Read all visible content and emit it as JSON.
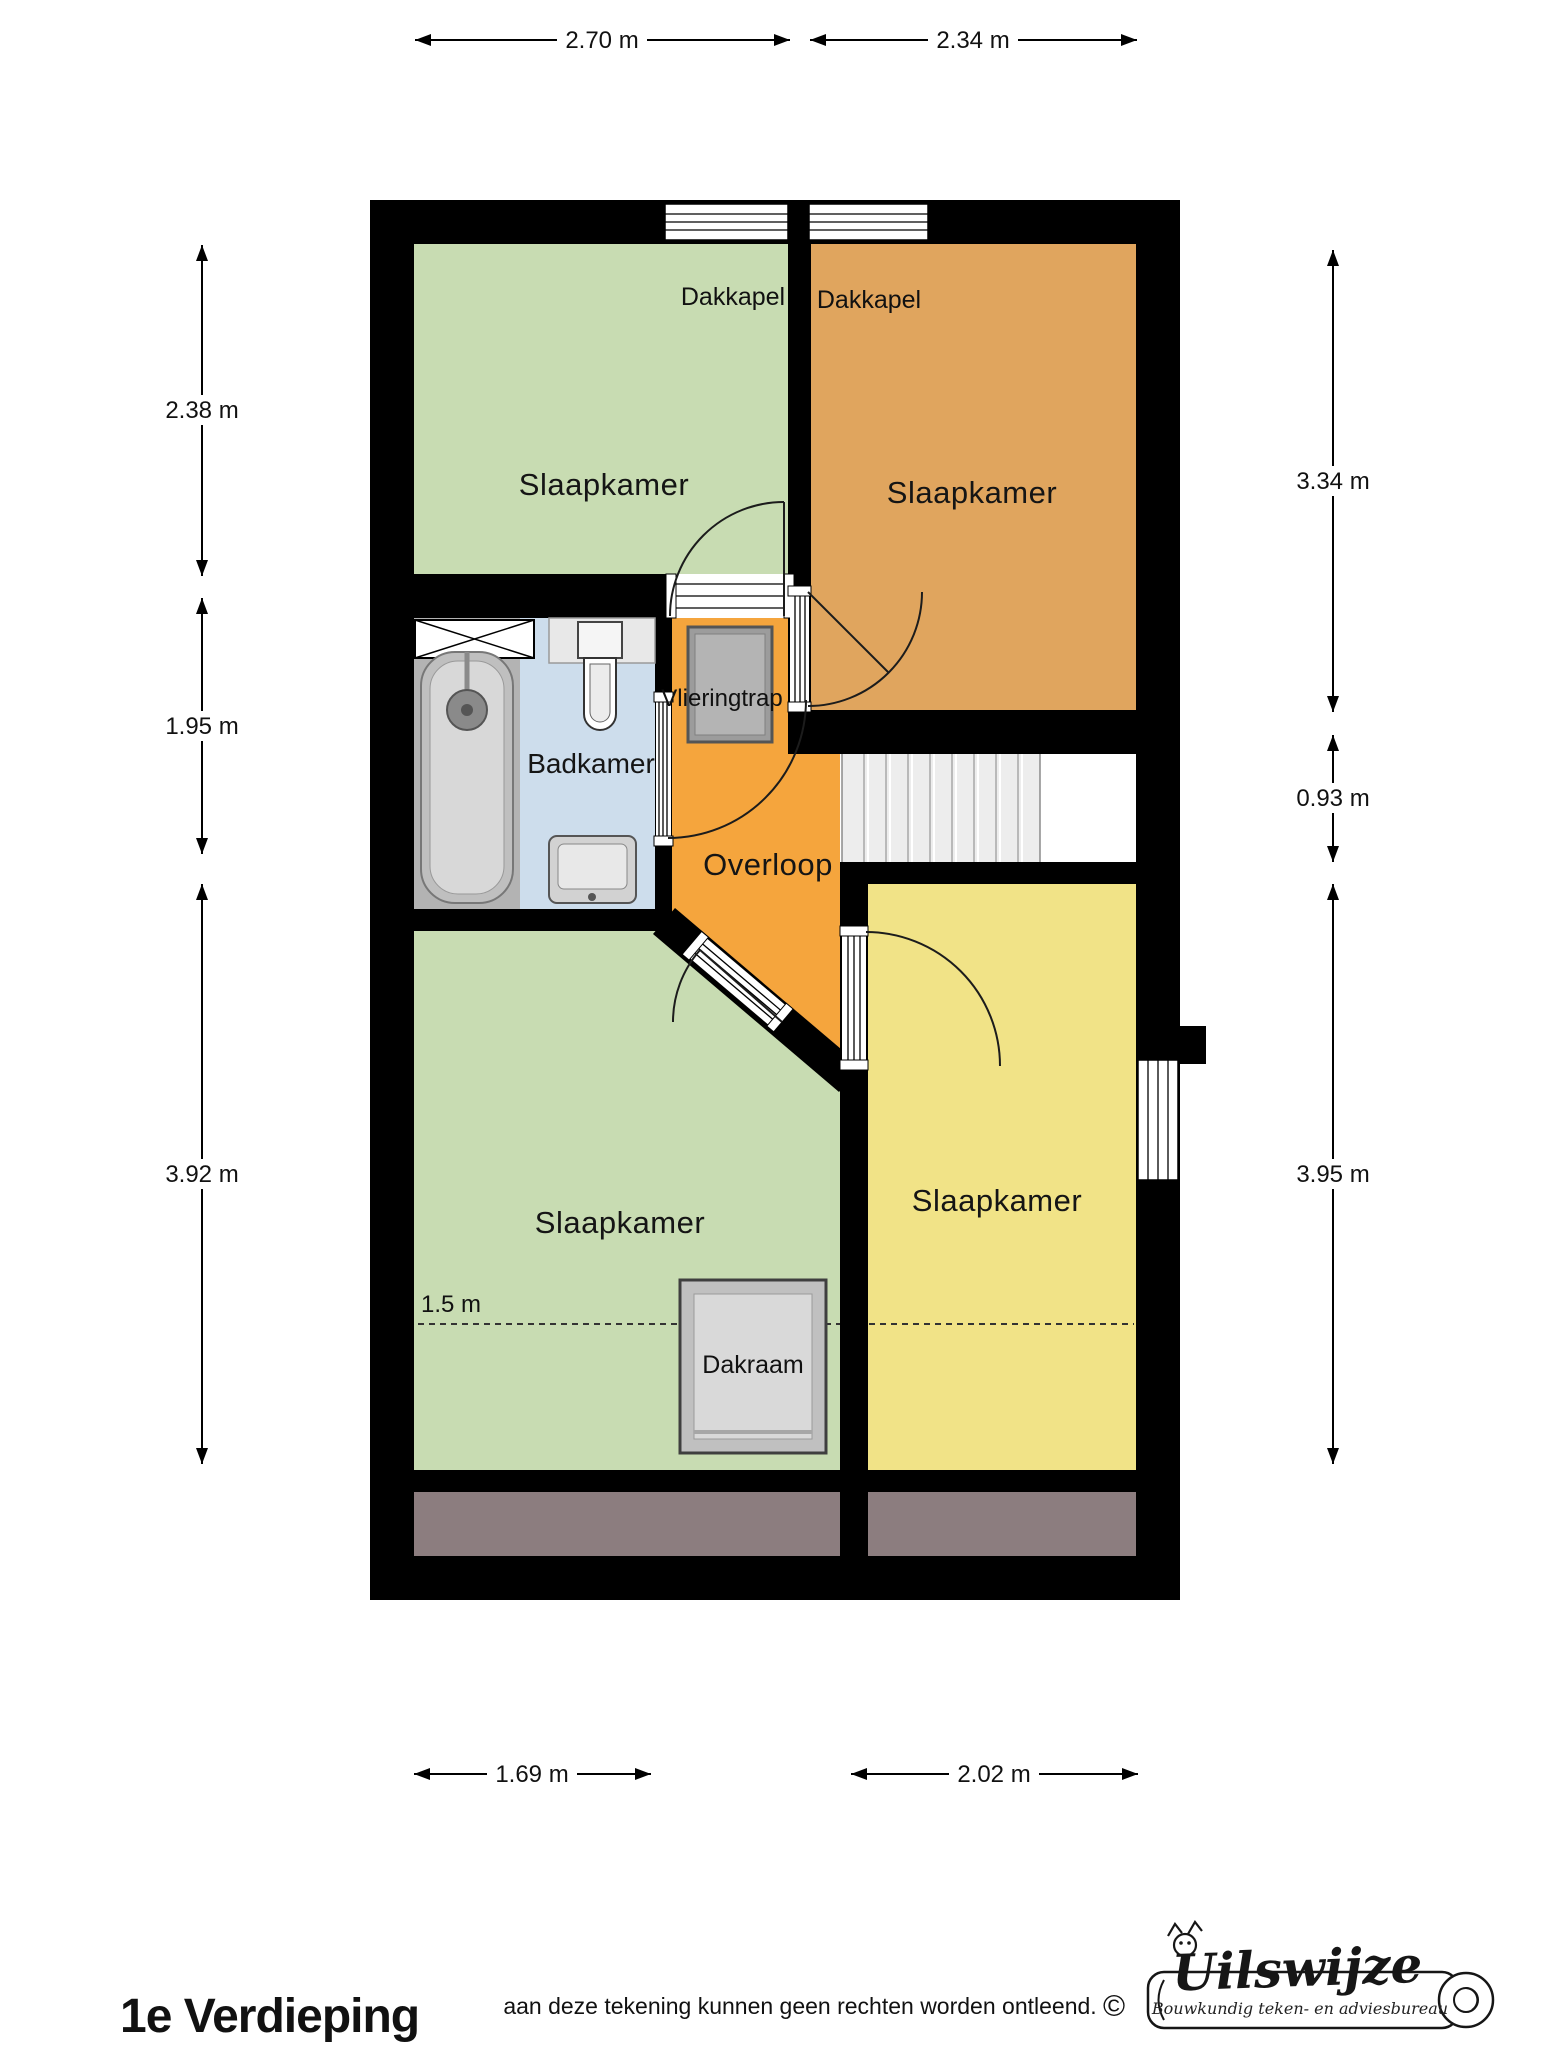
{
  "plan": {
    "rooms": {
      "slaapkamer_nw": "Slaapkamer",
      "slaapkamer_ne": "Slaapkamer",
      "slaapkamer_sw": "Slaapkamer",
      "slaapkamer_se": "Slaapkamer",
      "badkamer": "Badkamer",
      "overloop": "Overloop"
    },
    "features": {
      "dakkapel_left": "Dakkapel",
      "dakkapel_right": "Dakkapel",
      "vlieringtrap": "Vlieringtrap",
      "dakraam": "Dakraam",
      "headroom_line": "1.5 m"
    },
    "dimensions": {
      "top": [
        {
          "label": "2.70 m"
        },
        {
          "label": "2.34 m"
        }
      ],
      "left": [
        {
          "label": "2.38 m"
        },
        {
          "label": "1.95 m"
        },
        {
          "label": "3.92 m"
        }
      ],
      "right": [
        {
          "label": "3.34 m"
        },
        {
          "label": "0.93 m"
        },
        {
          "label": "3.95 m"
        }
      ],
      "bottom": [
        {
          "label": "1.69 m"
        },
        {
          "label": "2.02 m"
        }
      ]
    }
  },
  "footer": {
    "title": "1e Verdieping",
    "disclaimer": "aan deze tekening kunnen geen rechten worden ontleend.",
    "copyright_symbol": "©"
  },
  "logo": {
    "name": "Uilswijze",
    "subtitle": "Bouwkundig teken- en adviesbureau"
  },
  "colors": {
    "wall": "#000000",
    "bedroom_green": "#c8dcb2",
    "bedroom_orange": "#e0a55e",
    "bedroom_yellow": "#f1e387",
    "landing_orange": "#f5a53d",
    "bathroom_blue": "#cdddec",
    "attic_brown": "#8c7d7f",
    "stair_grey": "#ededed"
  }
}
